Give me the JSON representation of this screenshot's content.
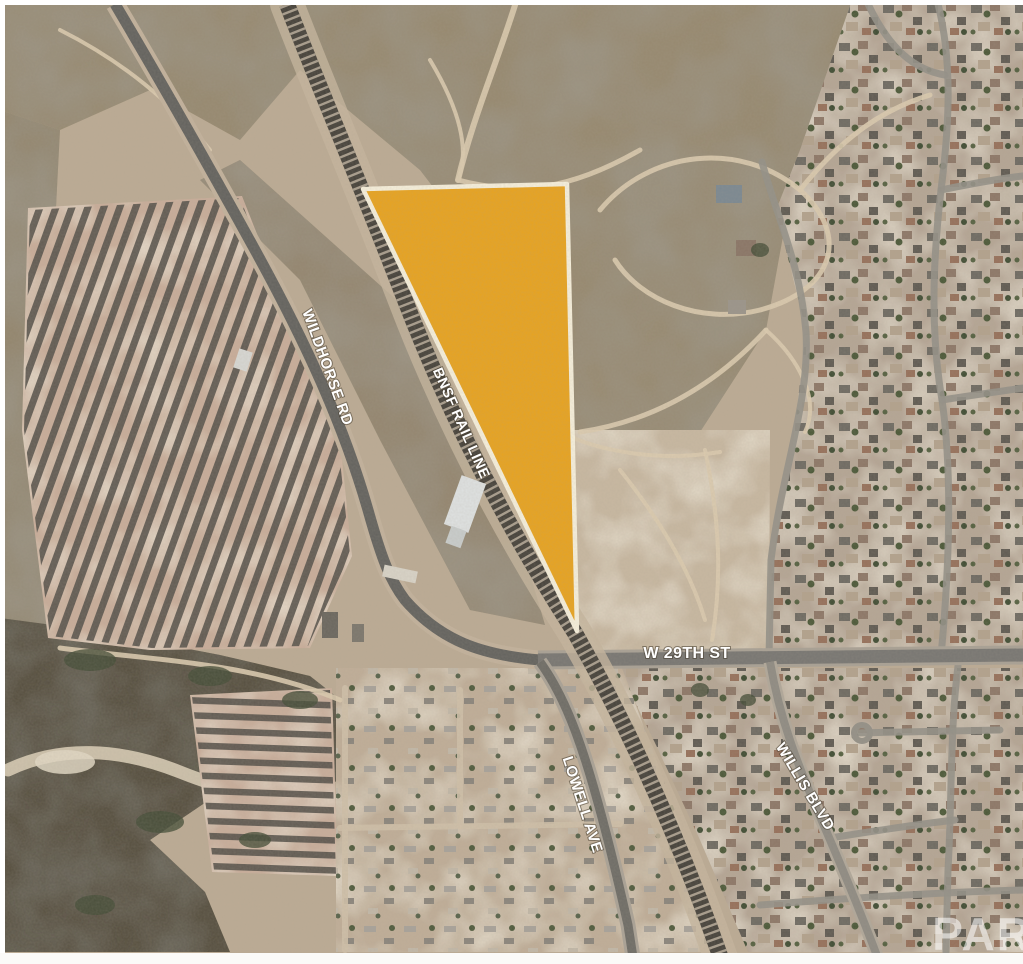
{
  "map": {
    "road_labels": [
      {
        "id": "wildhorse-rd",
        "text": "WILDHORSE RD"
      },
      {
        "id": "bnsf-rail-line",
        "text": "BNSF RAIL LINE"
      },
      {
        "id": "w-29th-st",
        "text": "W 29TH ST"
      },
      {
        "id": "lowell-ave",
        "text": "LOWELL AVE"
      },
      {
        "id": "willis-blvd",
        "text": "WILLIS BLVD"
      }
    ],
    "watermark_text": "PAR",
    "colors": {
      "parcel_fill": "#E8A31F",
      "parcel_border": "#F7F0DC",
      "label_text": "#FFFFFF"
    }
  }
}
